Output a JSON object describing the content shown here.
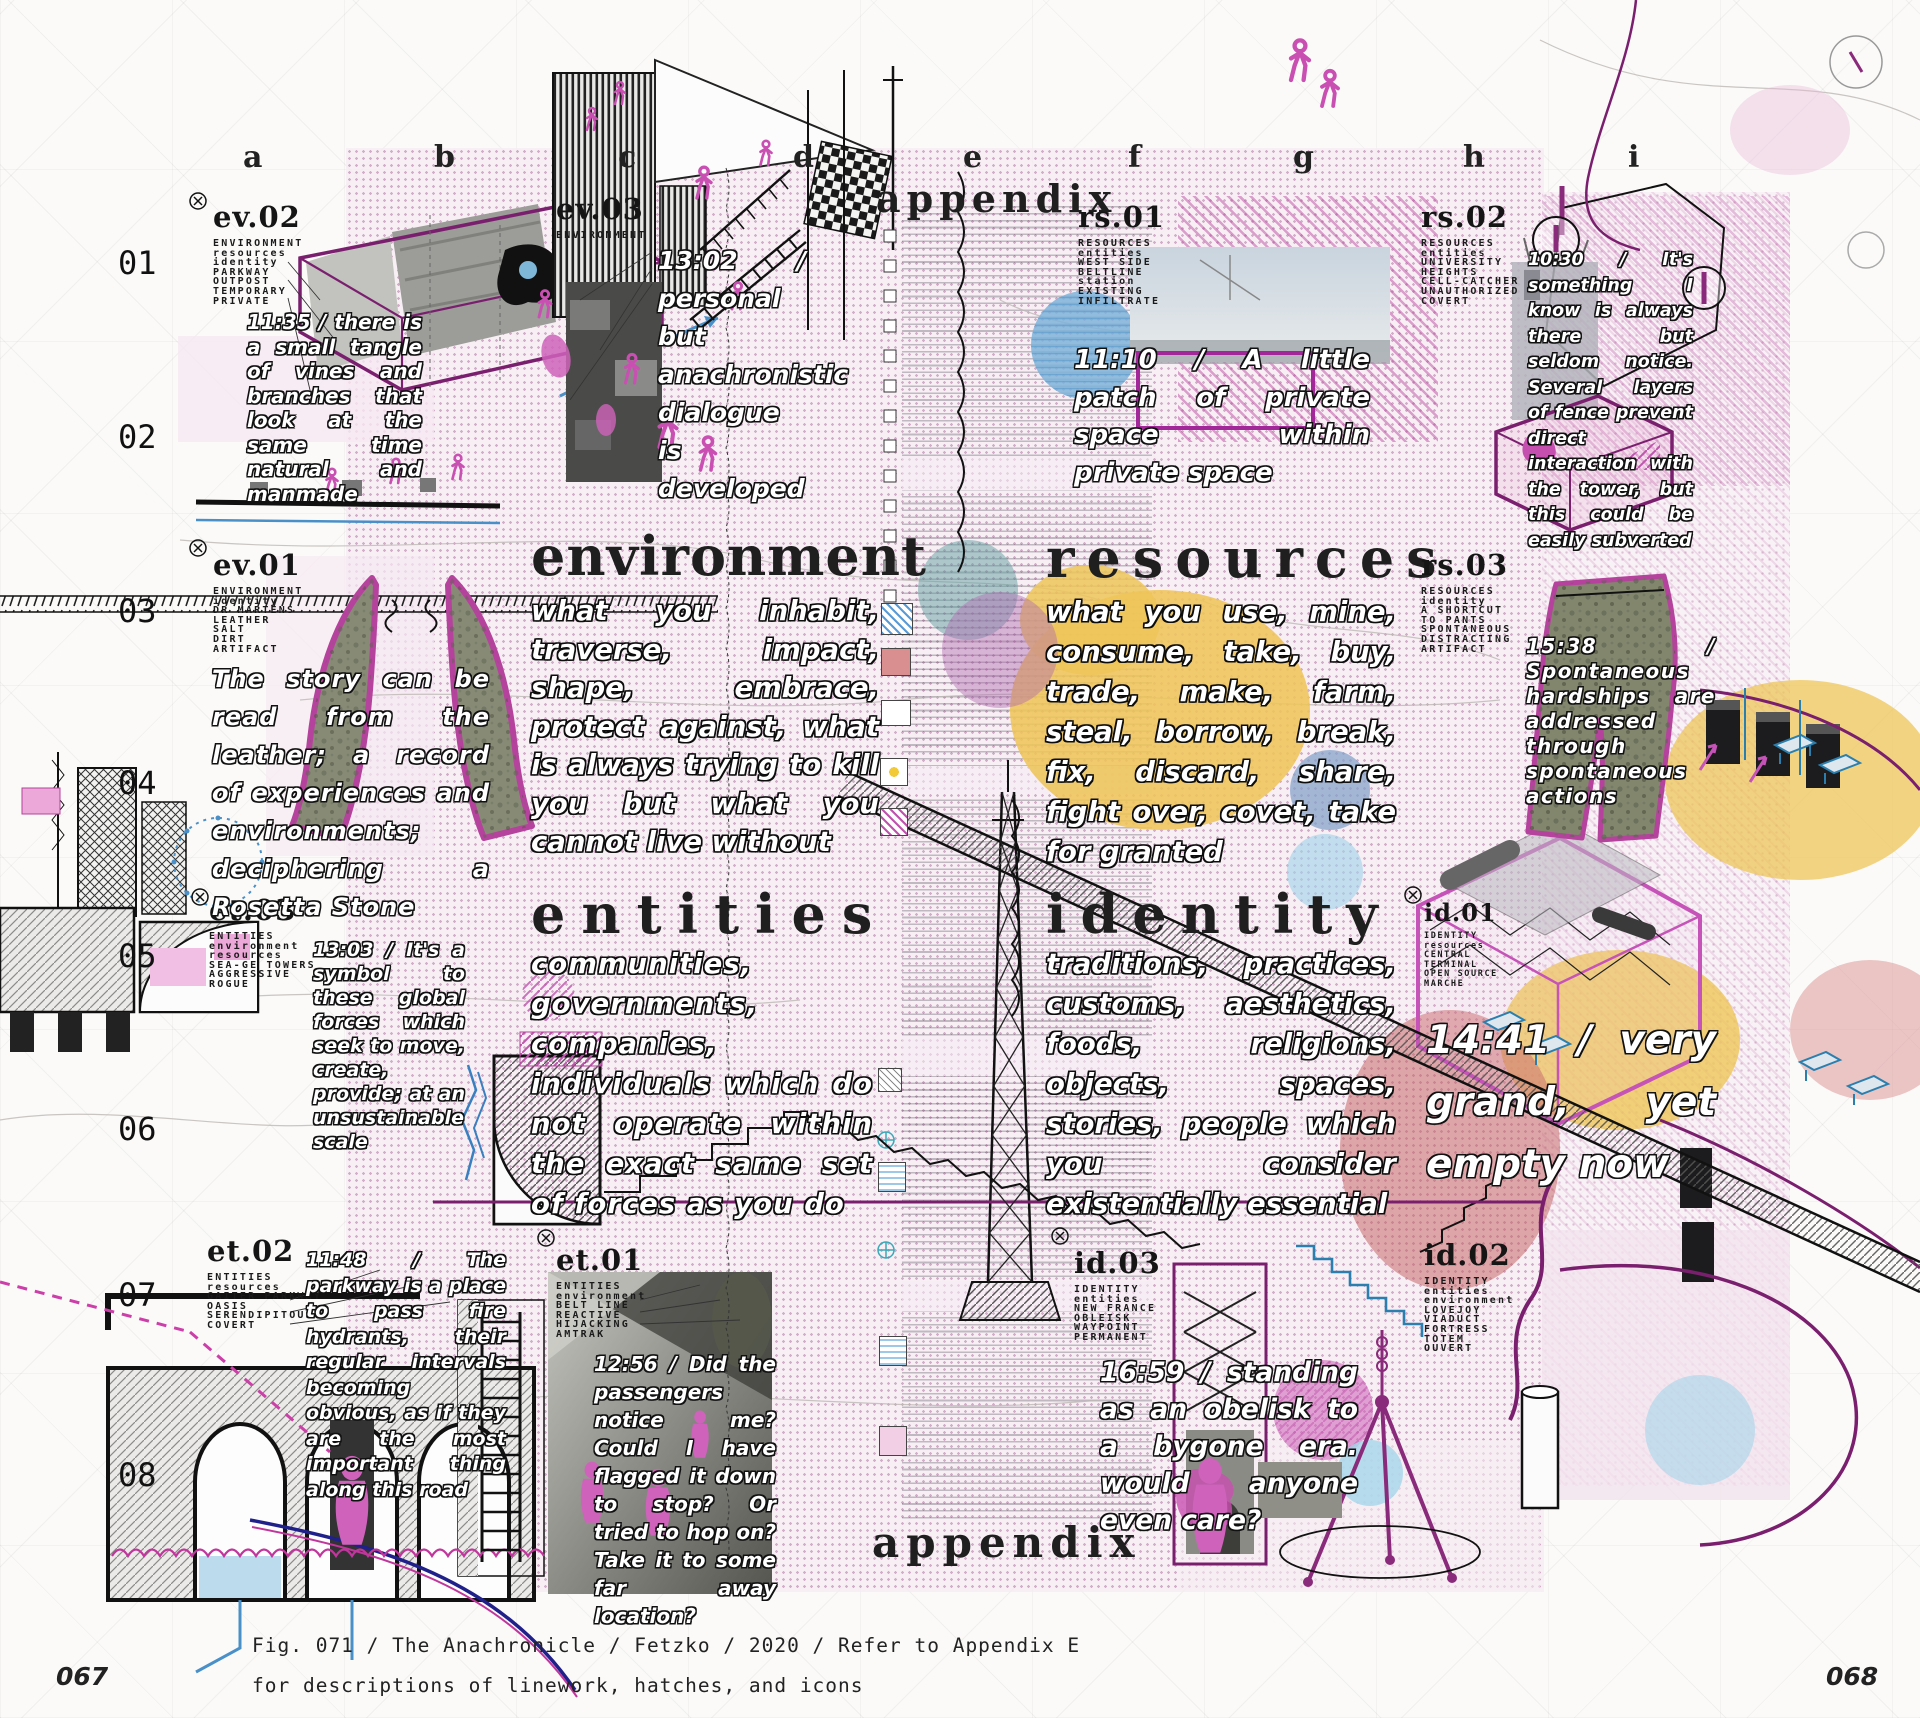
{
  "page": {
    "caption_line1": "Fig. 071 / The Anachronicle / Fetzko / 2020 / Refer to Appendix E",
    "caption_line2": "for descriptions of linework, hatches, and icons",
    "page_left": "067",
    "page_right": "068"
  },
  "grid": {
    "columns": [
      "a",
      "b",
      "c",
      "d",
      "e",
      "f",
      "g",
      "h",
      "i"
    ],
    "rows": [
      "01",
      "02",
      "03",
      "04",
      "05",
      "06",
      "07",
      "08"
    ]
  },
  "labels": {
    "appendix_top": "appendix",
    "appendix_bottom": "appendix"
  },
  "sections": {
    "environment": {
      "title": "environment",
      "body": "what you inhabit, traverse, impact, shape, embrace, protect against, what is always trying to kill you but what you cannot live without"
    },
    "resources": {
      "title": "resources",
      "body": "what you use, mine, consume, take, buy, trade, make, farm, steal, borrow, break, fix, discard, share, fight over, covet, take for granted"
    },
    "entities": {
      "title": "entities",
      "body": "communities, governments, companies, individuals which do not operate within the exact same set of forces as you do"
    },
    "identity": {
      "title": "identity",
      "body": "traditions, practices, customs, aesthetics, foods, religions, objects, spaces, stories, people which you consider existentially essential"
    }
  },
  "callouts": {
    "ev02": {
      "code": "ev.02",
      "tags": "ENVIRONMENT\nresources\nidentity\nPARKWAY\nOUTPOST\nTEMPORARY\nPRIVATE",
      "note": "11:35 / there is a small tangle of vines and branches that look at the same time natural and manmade"
    },
    "ev03": {
      "code": "ev.03",
      "tags": "ENVIRONMENT",
      "note": "13:02 / personal but anachronistic dialogue is developed"
    },
    "ev01": {
      "code": "ev.01",
      "tags": "ENVIRONMENT\nidentity\nDR MARTENS\nLEATHER\nSALT\nDIRT\nARTIFACT",
      "note": "The story can be read from the leather; a record of experiences and environments; deciphering a Rosetta Stone"
    },
    "rs01": {
      "code": "rs.01",
      "tags": "RESOURCES\nentities\nWEST SIDE\nBELTLINE\nstation\nEXISTING\nINFILTRATE",
      "note": "11:10 / A little patch of private space within private space"
    },
    "rs02": {
      "code": "rs.02",
      "tags": "RESOURCES\nentities\nUNIVERSITY\nHEIGHTS\nCELL-CATCHER\nUNAUTHORIZED\nCOVERT",
      "note": "10:30 / It's something I know is always there but seldom notice. Several layers of fence prevent direct interaction with the tower, but this could be easily subverted"
    },
    "rs03": {
      "code": "rs.03",
      "tags": "RESOURCES\nidentity\nA SHORTCUT\nTO PANTS\nSPONTANEOUS\nDISTRACTING\nARTIFACT",
      "note": "15:38 / Spontaneous hardships are addressed through spontaneous actions"
    },
    "et03": {
      "code": "et.03",
      "tags": "ENTITIES\nenvironment\nresources\nSEA-GE TOWERS\nAGGRESSIVE\nROGUE",
      "note": "13:03 / It's a symbol to these global forces which seek to move, create, provide; at an unsustainable scale"
    },
    "et02": {
      "code": "et.02",
      "tags": "ENTITIES\nresources\nGAITER PARKWAY\nOASIS\nSERENDIPITOUS\nCOVERT",
      "note": "11:48 / The parkway is a place to pass fire hydrants, their regular intervals becoming obvious, as if they are the most important thing along this road"
    },
    "et01": {
      "code": "et.01",
      "tags": "ENTITIES\nenvironment\nBELT LINE\nREACTIVE\nHIJACKING\nAMTRAK",
      "note": "12:56 / Did the passengers notice me? Could I have flagged it down to stop? Or tried to hop on? Take it to some far away location?"
    },
    "id01": {
      "code": "id.01",
      "tags": "IDENTITY\nresources\nCENTRAL\nTERMINAL\nOPEN SOURCE\nMARCHE",
      "note": "14:41 / very grand, yet empty now"
    },
    "id02": {
      "code": "id.02",
      "tags": "IDENTITY\nentities\nenvironment\nLOVEJOY\nVIADUCT\nFORTRESS\nTOTEM\nOUVERT",
      "note": ""
    },
    "id03": {
      "code": "id.03",
      "tags": "IDENTITY\nentities\nNEW FRANCE\nOBLEISK\nWAYPOINT\nPERMANENT",
      "note": "16:59 / standing as an obelisk to a bygone era. would anyone even care?"
    }
  },
  "colors": {
    "magenta": "#c653b8",
    "purple": "#7a1f6e",
    "blue": "#4a90c8",
    "yellow": "#eec559",
    "rose": "#c25b5b",
    "panel_pink": "#f4e6f0"
  }
}
